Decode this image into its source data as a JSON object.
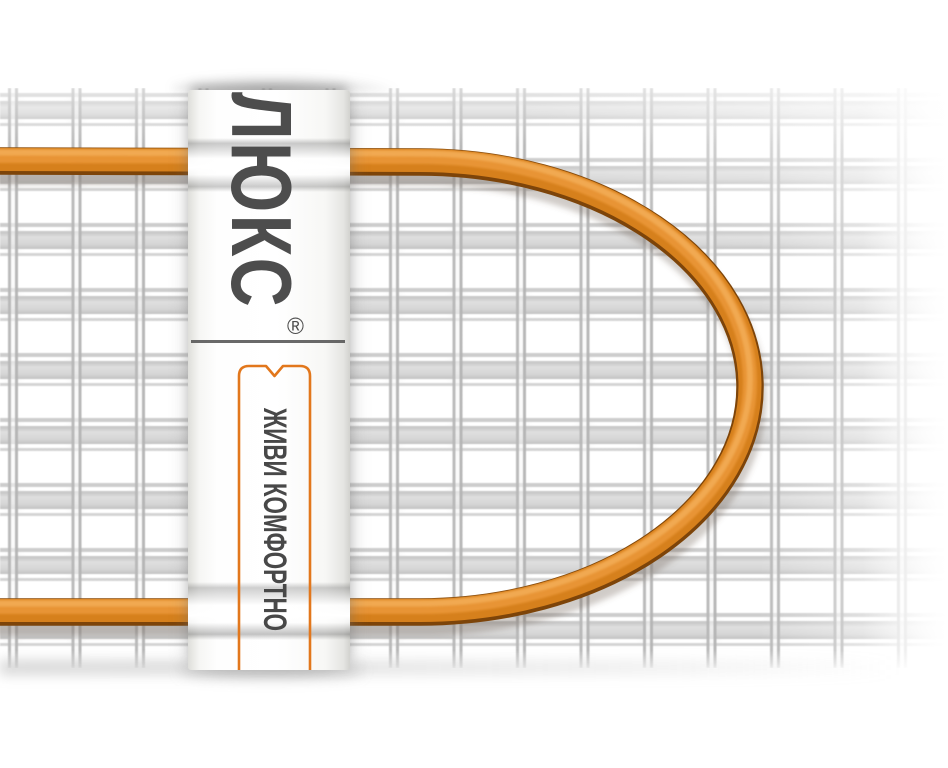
{
  "label": {
    "brand": "ЛЮКС",
    "registered_mark": "®",
    "slogan": "ЖИВИ КОМФОРТНО"
  },
  "colors": {
    "background": "#ffffff",
    "cable_mid": "#d6801c",
    "cable_highlight": "#f2ac55",
    "cable_dark": "#7d4409",
    "ribbon_orange": "#e2771c",
    "text_gray": "#4d4d4d",
    "mesh_gray": "#d6d6d6"
  }
}
